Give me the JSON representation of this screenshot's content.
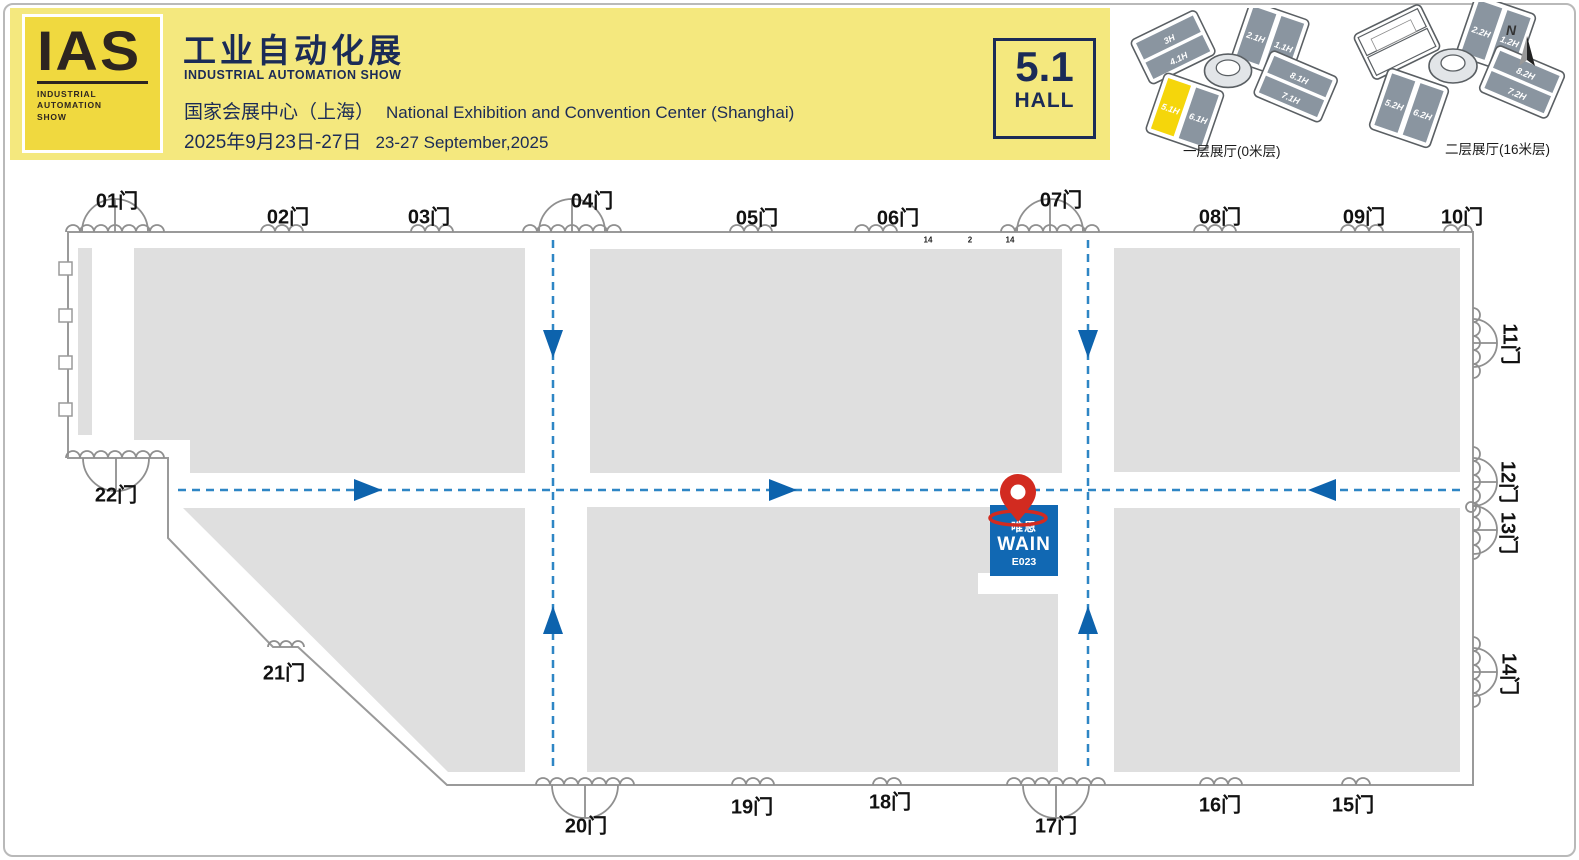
{
  "header": {
    "logo": {
      "acronym": "IAS",
      "tagline1": "INDUSTRIAL",
      "tagline2": "AUTOMATION",
      "tagline3": "SHOW"
    },
    "title_cn": "工业自动化展",
    "title_en": "INDUSTRIAL AUTOMATION SHOW",
    "venue_cn": "国家会展中心（上海）",
    "venue_en": "National Exhibition and Convention Center (Shanghai)",
    "dates_cn": "2025年9月23日-27日",
    "dates_en": "23-27 September,2025",
    "hall_badge": {
      "number": "5.1",
      "label": "HALL"
    }
  },
  "overview_maps": {
    "floor1": {
      "caption": "一层展厅(0米层)",
      "halls": {
        "nw": [
          "3H",
          "4.1H"
        ],
        "ne": [
          "2.1H",
          "1.1H"
        ],
        "e": [
          "8.1H",
          "7.1H"
        ],
        "sw": [
          "5.1H",
          "6.1H"
        ]
      },
      "highlighted_hall": "5.1H"
    },
    "floor2": {
      "caption": "二层展厅(16米层)",
      "halls": {
        "ne": [
          "2.2H",
          "1.2H"
        ],
        "e": [
          "8.2H",
          "7.2H"
        ],
        "sw": [
          "5.2H",
          "6.2H"
        ]
      }
    },
    "compass": "N"
  },
  "plan": {
    "gates": [
      "01门",
      "02门",
      "03门",
      "04门",
      "05门",
      "06门",
      "07门",
      "08门",
      "09门",
      "10门",
      "11门",
      "12门",
      "13门",
      "14门",
      "15门",
      "16门",
      "17门",
      "18门",
      "19门",
      "20门",
      "21门",
      "22门"
    ],
    "wall_marks": [
      "14",
      "2",
      "14"
    ],
    "booth": {
      "name_cn": "唯恩",
      "name_en": "WAIN",
      "booth_no": "E023"
    }
  },
  "colors": {
    "banner_yellow": "#F4E87E",
    "logo_gold": "#F0D93F",
    "navy": "#1B2B57",
    "block_gray": "#DFDFDF",
    "dash_blue": "#2E86C5",
    "arrow_blue": "#0D63AD",
    "booth_blue": "#1168B3",
    "pin_red": "#D22B20",
    "inset_hall_slate": "#8A95A0",
    "highlight_yellow": "#F5D60B"
  }
}
